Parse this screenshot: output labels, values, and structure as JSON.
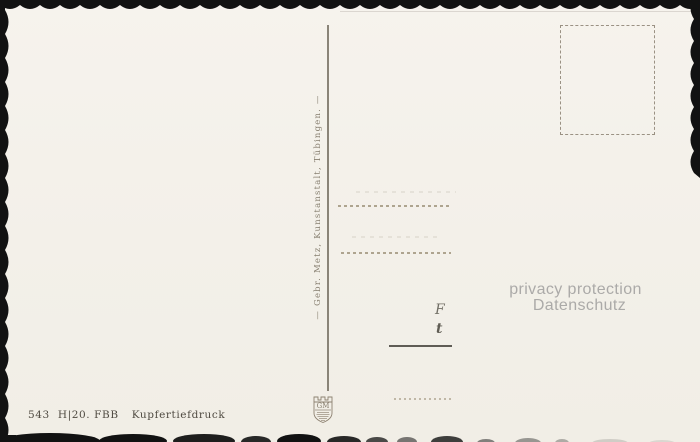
{
  "postcard": {
    "publisher_vertical_text": "— Gebr. Metz, Kunstanstalt, Tübingen. —",
    "emblem_monogram": "GM",
    "privacy_overlay": {
      "line1": "privacy protection",
      "line2": "Datenschutz"
    },
    "imprint": {
      "number": "543",
      "series": "H|20. FBB",
      "process": "Kupfertiefdruck"
    },
    "handwriting_remnants": {
      "mark1": "F",
      "mark2": "t"
    },
    "colors": {
      "card_background": "#f3f0e9",
      "deckle_edge": "#121212",
      "print_brown": "#877f70",
      "dashed_line": "#aea48f",
      "solid_line": "#5f5c55",
      "privacy_text": "#abaaa8",
      "imprint_text": "#4f4a41"
    }
  }
}
